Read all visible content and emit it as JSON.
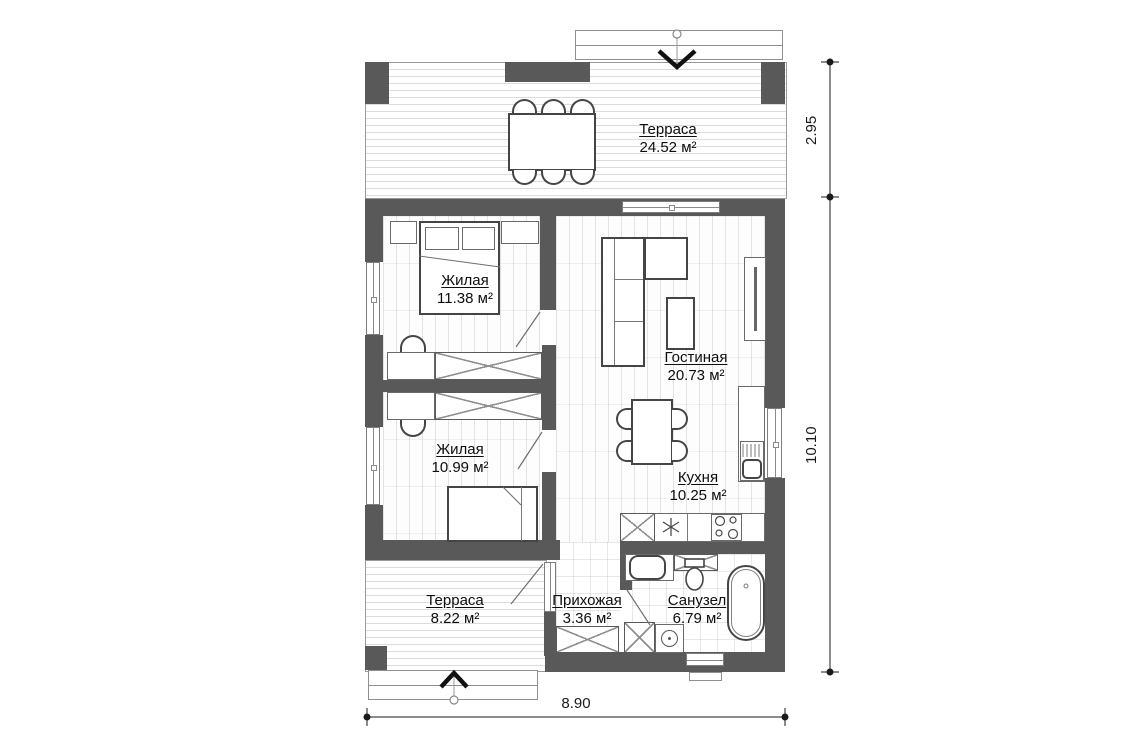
{
  "plan": {
    "rooms": [
      {
        "id": "terrace-top",
        "name": "Терраса",
        "area": "24.52 м²"
      },
      {
        "id": "bedroom-1",
        "name": "Жилая",
        "area": "11.38 м²"
      },
      {
        "id": "living-room",
        "name": "Гостиная",
        "area": "20.73 м²"
      },
      {
        "id": "bedroom-2",
        "name": "Жилая",
        "area": "10.99 м²"
      },
      {
        "id": "kitchen",
        "name": "Кухня",
        "area": "10.25 м²"
      },
      {
        "id": "terrace-bottom",
        "name": "Терраса",
        "area": "8.22 м²"
      },
      {
        "id": "hallway",
        "name": "Прихожая",
        "area": "3.36 м²"
      },
      {
        "id": "bathroom",
        "name": "Санузел",
        "area": "6.79 м²"
      }
    ],
    "dimensions": {
      "right_upper": "2.95",
      "right_lower": "10.10",
      "bottom": "8.90"
    },
    "colors": {
      "wall": "#595959",
      "furniture_outline": "#454545",
      "floor_line": "#dcdcdc",
      "text": "#0e0e0e"
    }
  }
}
